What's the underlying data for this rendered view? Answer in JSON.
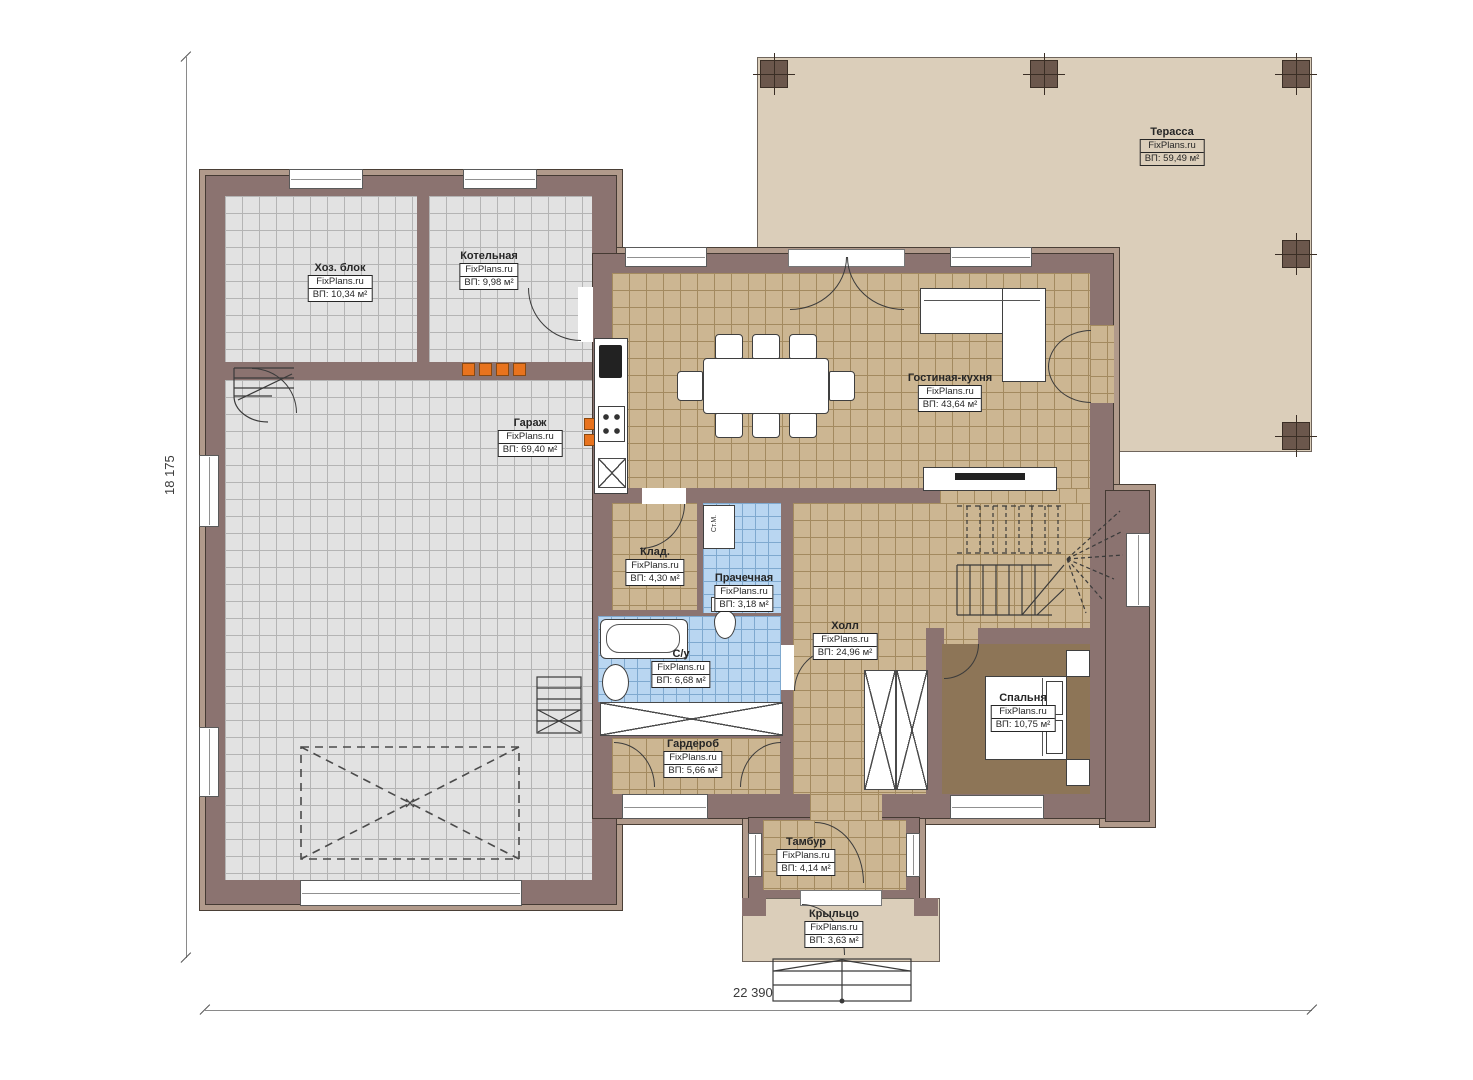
{
  "brand": "FixPlans.ru",
  "dimensions": {
    "vertical": "18 175",
    "horizontal": "22 390"
  },
  "rooms": [
    {
      "key": "terrace",
      "name": "Терасса",
      "area": "ВП: 59,49 м²"
    },
    {
      "key": "utility_block",
      "name": "Хоз. блок",
      "area": "ВП: 10,34 м²"
    },
    {
      "key": "boiler_room",
      "name": "Котельная",
      "area": "ВП: 9,98 м²"
    },
    {
      "key": "garage",
      "name": "Гараж",
      "area": "ВП: 69,40 м²"
    },
    {
      "key": "living_kitchen",
      "name": "Гостиная-кухня",
      "area": "ВП: 43,64 м²"
    },
    {
      "key": "pantry",
      "name": "Клад.",
      "area": "ВП: 4,30 м²"
    },
    {
      "key": "laundry",
      "name": "Прачечная",
      "area": "ВП: 3,18 м²"
    },
    {
      "key": "bathroom",
      "name": "С/у",
      "area": "ВП: 6,68 м²"
    },
    {
      "key": "hall",
      "name": "Холл",
      "area": "ВП: 24,96 м²"
    },
    {
      "key": "bedroom",
      "name": "Спальня",
      "area": "ВП: 10,75 м²"
    },
    {
      "key": "wardrobe",
      "name": "Гардероб",
      "area": "ВП: 5,66 м²"
    },
    {
      "key": "vestibule",
      "name": "Тамбур",
      "area": "ВП: 4,14 м²"
    },
    {
      "key": "porch",
      "name": "Крыльцо",
      "area": "ВП: 3,63 м²"
    }
  ],
  "appliances": {
    "washing_machine": "Ст.М."
  },
  "colors": {
    "wall": "#8b7370",
    "wall_trim": "#b19a8b",
    "terrace_floor": "#dbceba",
    "tile_gray": "#e2e2e2",
    "tile_tan": "#ccb692",
    "tile_blue": "#b9d6f1",
    "bedroom_floor": "#8d7557",
    "vent_marker": "#e8731e"
  }
}
